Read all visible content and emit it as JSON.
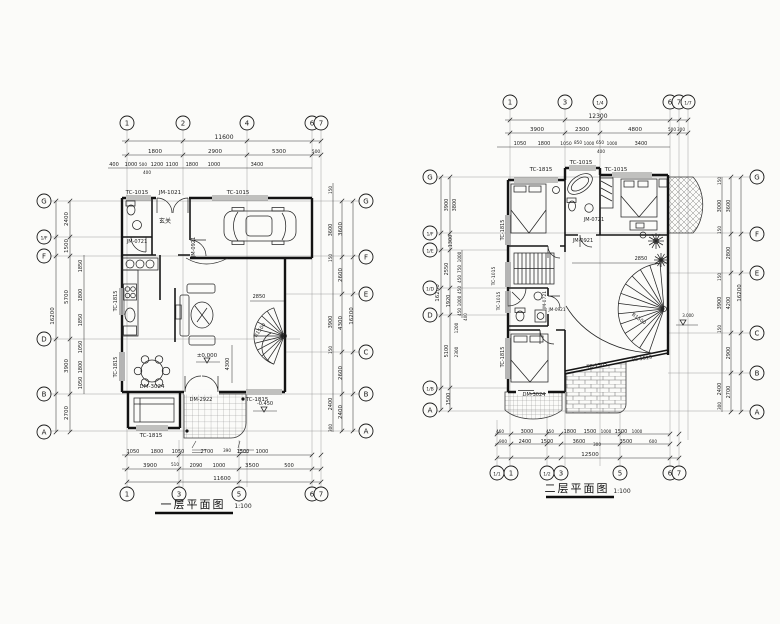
{
  "sheet": {
    "paper_color": "#fbfbf9",
    "ink_color": "#1b1b1b"
  },
  "plan1": {
    "title": "一层平面图",
    "scale": "1:100",
    "bubbles": [
      [
        "1",
        127,
        123,
        "top"
      ],
      [
        "2",
        183,
        123,
        "top"
      ],
      [
        "4",
        247,
        123,
        "top"
      ],
      [
        "6",
        312,
        123,
        "top"
      ],
      [
        "7",
        321,
        123,
        "top"
      ],
      [
        "1",
        127,
        494,
        "bottom"
      ],
      [
        "3",
        179,
        494,
        "bottom"
      ],
      [
        "5",
        239,
        494,
        "bottom"
      ],
      [
        "6",
        312,
        494,
        "bottom"
      ],
      [
        "7",
        321,
        494,
        "bottom"
      ],
      [
        "G",
        44,
        201,
        "left"
      ],
      [
        "1/F",
        44,
        237,
        "left"
      ],
      [
        "F",
        44,
        256,
        "left"
      ],
      [
        "D",
        44,
        339,
        "left"
      ],
      [
        "B",
        44,
        394,
        "left"
      ],
      [
        "A",
        44,
        432,
        "left"
      ],
      [
        "G",
        366,
        201,
        "right"
      ],
      [
        "F",
        366,
        257,
        "right"
      ],
      [
        "E",
        366,
        294,
        "right"
      ],
      [
        "C",
        366,
        352,
        "right"
      ],
      [
        "B",
        366,
        394,
        "right"
      ],
      [
        "A",
        366,
        431,
        "right"
      ]
    ],
    "texts": [
      [
        "11600",
        224,
        139
      ],
      [
        "1800",
        155,
        153,
        5.5
      ],
      [
        "2900",
        215,
        153,
        5.5
      ],
      [
        "5300",
        279,
        153,
        5.5
      ],
      [
        "500",
        316,
        153,
        4.5
      ],
      [
        "400",
        114,
        166,
        5
      ],
      [
        "1000",
        131,
        166,
        5
      ],
      [
        "500",
        143,
        166,
        4.2
      ],
      [
        "1200",
        157,
        166,
        5
      ],
      [
        "1100",
        172,
        166,
        5
      ],
      [
        "1800",
        192,
        166,
        5
      ],
      [
        "1000",
        214,
        166,
        5
      ],
      [
        "3400",
        257,
        166,
        5
      ],
      [
        "400",
        147,
        174,
        4.2
      ],
      [
        "16200",
        54,
        316,
        5.5,
        -90
      ],
      [
        "2400",
        68,
        219,
        5.5,
        -90
      ],
      [
        "1500",
        68,
        246,
        5.5,
        -90
      ],
      [
        "5700",
        68,
        297,
        5.5,
        -90
      ],
      [
        "3900",
        68,
        366,
        5.5,
        -90
      ],
      [
        "2700",
        68,
        413,
        5.5,
        -90
      ],
      [
        "1850",
        82,
        266,
        5,
        -90
      ],
      [
        "1800",
        82,
        295,
        5,
        -90
      ],
      [
        "1850",
        82,
        320,
        5,
        -90
      ],
      [
        "1050",
        82,
        347,
        5,
        -90
      ],
      [
        "1800",
        82,
        367,
        5,
        -90
      ],
      [
        "1050",
        82,
        383,
        5,
        -90
      ],
      [
        "16200",
        353,
        316,
        5.5,
        -90
      ],
      [
        "3600",
        342,
        229,
        5.5,
        -90
      ],
      [
        "2600",
        342,
        275,
        5.5,
        -90
      ],
      [
        "4300",
        342,
        323,
        5.5,
        -90
      ],
      [
        "2600",
        342,
        373,
        5.5,
        -90
      ],
      [
        "2400",
        342,
        412,
        5.5,
        -90
      ],
      [
        "150",
        332,
        190,
        4.2,
        -90
      ],
      [
        "3600",
        332,
        230,
        5,
        -90
      ],
      [
        "150",
        332,
        258,
        4.2,
        -90
      ],
      [
        "3900",
        332,
        322,
        5,
        -90
      ],
      [
        "150",
        332,
        350,
        4.2,
        -90
      ],
      [
        "2400",
        332,
        404,
        5,
        -90
      ],
      [
        "300",
        332,
        428,
        4.2,
        -90
      ],
      [
        "1050",
        133,
        453,
        5
      ],
      [
        "1800",
        157,
        453,
        5
      ],
      [
        "1050",
        178,
        453,
        5
      ],
      [
        "2700",
        207,
        453,
        5
      ],
      [
        "390",
        227,
        452,
        4.2
      ],
      [
        "1500",
        243,
        453,
        5
      ],
      [
        "1000",
        262,
        453,
        5
      ],
      [
        "3900",
        150,
        467,
        5.5
      ],
      [
        "510",
        175,
        466,
        4.2
      ],
      [
        "2090",
        196,
        467,
        5
      ],
      [
        "1000",
        219,
        467,
        5
      ],
      [
        "3500",
        252,
        467,
        5.5
      ],
      [
        "500",
        289,
        467,
        5
      ],
      [
        "11600",
        222,
        480,
        5.5
      ],
      [
        "TC-1015",
        137,
        194,
        5.5
      ],
      [
        "JM-1021",
        170,
        194,
        5.5
      ],
      [
        "TC-1015",
        238,
        194,
        5.5
      ],
      [
        "JM-0721",
        137,
        243,
        5
      ],
      [
        "JM-0921",
        195,
        247,
        5,
        -90
      ],
      [
        "玄关",
        165,
        223,
        6
      ],
      [
        "TC-1815",
        117,
        301,
        5,
        -90
      ],
      [
        "TC-1815",
        117,
        367,
        5,
        -90
      ],
      [
        "DM-3024",
        152,
        388,
        5.5
      ],
      [
        "DM-2922",
        201,
        401,
        5
      ],
      [
        "TC-1815",
        257,
        401,
        5.5
      ],
      [
        "TC-1815",
        151,
        437,
        5.5
      ],
      [
        "2850",
        259,
        298,
        5
      ],
      [
        "R1500",
        261,
        331,
        5,
        -55
      ],
      [
        "±0.000",
        207,
        357,
        5.5
      ],
      [
        "-0.450",
        265,
        405,
        5
      ],
      [
        "4300",
        229,
        364,
        5,
        -90
      ]
    ]
  },
  "plan2": {
    "title": "二层平面图",
    "scale": "1:100",
    "bubbles": [
      [
        "1",
        510,
        102,
        "top"
      ],
      [
        "3",
        565,
        102,
        "top"
      ],
      [
        "1/4",
        600,
        102,
        "top"
      ],
      [
        "6",
        670,
        102,
        "top"
      ],
      [
        "7",
        679,
        102,
        "top"
      ],
      [
        "1/7",
        688,
        102,
        "top"
      ],
      [
        "1/1",
        497,
        473,
        "bottom"
      ],
      [
        "1",
        511,
        473,
        "bottom"
      ],
      [
        "1/2",
        547,
        473,
        "bottom"
      ],
      [
        "3",
        561,
        473,
        "bottom"
      ],
      [
        "5",
        620,
        473,
        "bottom"
      ],
      [
        "6",
        670,
        473,
        "bottom"
      ],
      [
        "7",
        679,
        473,
        "bottom"
      ],
      [
        "G",
        430,
        177,
        "left"
      ],
      [
        "1/F",
        430,
        233,
        "left"
      ],
      [
        "1/E",
        430,
        250,
        "left"
      ],
      [
        "1/D",
        430,
        288,
        "left"
      ],
      [
        "D",
        430,
        315,
        "left"
      ],
      [
        "1/B",
        430,
        388,
        "left"
      ],
      [
        "A",
        430,
        410,
        "left"
      ],
      [
        "G",
        757,
        177,
        "right"
      ],
      [
        "F",
        757,
        234,
        "right"
      ],
      [
        "E",
        757,
        273,
        "right"
      ],
      [
        "C",
        757,
        333,
        "right"
      ],
      [
        "B",
        757,
        373,
        "right"
      ],
      [
        "A",
        757,
        412,
        "right"
      ]
    ],
    "texts": [
      [
        "12300",
        598,
        118
      ],
      [
        "3900",
        537,
        131,
        5.5
      ],
      [
        "2300",
        582,
        131,
        5.5
      ],
      [
        "4800",
        635,
        131,
        5.5
      ],
      [
        "500",
        672,
        131,
        4.2
      ],
      [
        "300",
        681,
        131,
        4.2
      ],
      [
        "1050",
        520,
        145,
        5
      ],
      [
        "1800",
        544,
        145,
        5
      ],
      [
        "1050",
        566,
        145,
        4.5
      ],
      [
        "850",
        578,
        144,
        4.2
      ],
      [
        "1000",
        589,
        145,
        4.2
      ],
      [
        "650",
        600,
        144,
        4.2
      ],
      [
        "1000",
        612,
        145,
        4.2
      ],
      [
        "3400",
        641,
        145,
        5
      ],
      [
        "400",
        601,
        153,
        4.2
      ],
      [
        "16200",
        439,
        293,
        5.5,
        -90
      ],
      [
        "3900",
        448,
        205,
        5,
        -90
      ],
      [
        "3800",
        456,
        205,
        5,
        -90
      ],
      [
        "1300",
        452,
        241,
        5,
        -90
      ],
      [
        "2550",
        448,
        269,
        5,
        -90
      ],
      [
        "1000",
        461,
        257,
        4.2,
        -90
      ],
      [
        "750",
        461,
        269,
        4.2,
        -90
      ],
      [
        "450",
        461,
        279,
        4.2,
        -90
      ],
      [
        "1920",
        450,
        301,
        5,
        -90
      ],
      [
        "450",
        461,
        290,
        4.2,
        -90
      ],
      [
        "1000",
        461,
        301,
        4.2,
        -90
      ],
      [
        "450",
        461,
        312,
        4.2,
        -90
      ],
      [
        "400",
        467,
        317,
        4,
        -90
      ],
      [
        "5100",
        448,
        351,
        5,
        -90
      ],
      [
        "1200",
        458,
        328,
        4.2,
        -90
      ],
      [
        "2300",
        458,
        352,
        4.2,
        -90
      ],
      [
        "1500",
        450,
        399,
        5,
        -90
      ],
      [
        "16200",
        741,
        293,
        5.5,
        -90
      ],
      [
        "3600",
        730,
        206,
        5,
        -90
      ],
      [
        "2800",
        730,
        253,
        5,
        -90
      ],
      [
        "4200",
        730,
        303,
        5,
        -90
      ],
      [
        "2900",
        730,
        353,
        5,
        -90
      ],
      [
        "2700",
        730,
        392,
        5,
        -90
      ],
      [
        "150",
        721,
        181,
        4.2,
        -90
      ],
      [
        "3000",
        721,
        206,
        5,
        -90
      ],
      [
        "150",
        721,
        230,
        4.2,
        -90
      ],
      [
        "150",
        721,
        277,
        4.2,
        -90
      ],
      [
        "3900",
        721,
        303,
        5,
        -90
      ],
      [
        "150",
        721,
        329,
        4.2,
        -90
      ],
      [
        "2400",
        721,
        389,
        5,
        -90
      ],
      [
        "300",
        721,
        406,
        4.2,
        -90
      ],
      [
        "460",
        500,
        433,
        4.2
      ],
      [
        "3000",
        527,
        433,
        5
      ],
      [
        "450",
        550,
        433,
        4.2
      ],
      [
        "1800",
        570,
        433,
        5
      ],
      [
        "1500",
        590,
        433,
        5
      ],
      [
        "1000",
        606,
        433,
        4.2
      ],
      [
        "1500",
        621,
        433,
        5
      ],
      [
        "1000",
        637,
        433,
        4.2
      ],
      [
        "900",
        503,
        443,
        4.2
      ],
      [
        "2400",
        525,
        443,
        5
      ],
      [
        "1500",
        547,
        443,
        5
      ],
      [
        "3600",
        579,
        443,
        5
      ],
      [
        "300",
        597,
        446,
        4.2
      ],
      [
        "3500",
        626,
        443,
        5
      ],
      [
        "600",
        653,
        443,
        4.2
      ],
      [
        "12500",
        590,
        456,
        5.5
      ],
      [
        "TC-1815",
        541,
        171,
        5.5
      ],
      [
        "TC-1015",
        581,
        164,
        5.5
      ],
      [
        "TC-1015",
        616,
        171,
        5.5
      ],
      [
        "JM-0721",
        594,
        221,
        5
      ],
      [
        "JM-0921",
        583,
        242,
        5
      ],
      [
        "TC-1815",
        504,
        230,
        5,
        -90
      ],
      [
        "TC-1015",
        495,
        276,
        4.5,
        -90
      ],
      [
        "TC-1015",
        500,
        301,
        4.5,
        -90
      ],
      [
        "JM-0721",
        546,
        300,
        4.5,
        -90
      ],
      [
        "JM-0921",
        557,
        311,
        4.2
      ],
      [
        "TC-1815",
        504,
        357,
        5,
        -90
      ],
      [
        "DM-3024",
        534,
        396,
        5
      ],
      [
        "TC-1505",
        597,
        367,
        5,
        -8
      ],
      [
        "TC-1515",
        642,
        360,
        5,
        -8
      ],
      [
        "2850",
        641,
        260,
        5
      ],
      [
        "R1500",
        638,
        320,
        5,
        35
      ],
      [
        "3.000",
        688,
        317,
        4
      ]
    ]
  }
}
